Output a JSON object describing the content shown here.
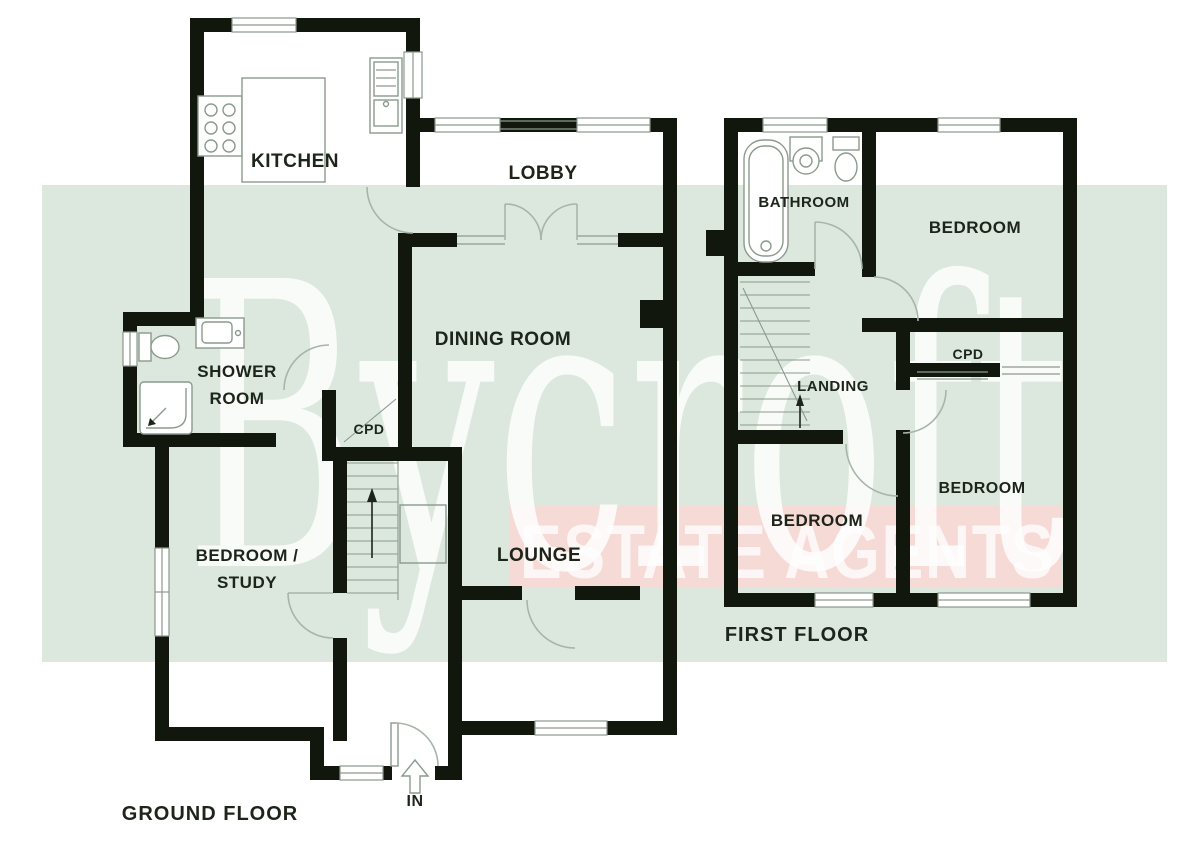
{
  "watermark": {
    "brand": "Bycroft",
    "tagline": "ESTATE AGENTS"
  },
  "colors": {
    "wall": "#12170e",
    "label": "#1d251a",
    "thin": "#8a9a8c",
    "arc": "#a7b5a8",
    "band_green": "#dce8dd",
    "band_pink": "#f6dad6",
    "watermark": "#ffffff"
  },
  "ground_floor": {
    "title": "GROUND FLOOR",
    "rooms": {
      "kitchen": "KITCHEN",
      "lobby": "LOBBY",
      "dining": "DINING ROOM",
      "shower_line1": "SHOWER",
      "shower_line2": "ROOM",
      "cpd": "CPD",
      "bedroom_study_line1": "BEDROOM /",
      "bedroom_study_line2": "STUDY",
      "lounge": "LOUNGE",
      "entrance": "IN"
    }
  },
  "first_floor": {
    "title": "FIRST FLOOR",
    "rooms": {
      "bathroom": "BATHROOM",
      "bedroom_top": "BEDROOM",
      "cpd": "CPD",
      "landing": "LANDING",
      "bedroom_left": "BEDROOM",
      "bedroom_right": "BEDROOM"
    }
  }
}
